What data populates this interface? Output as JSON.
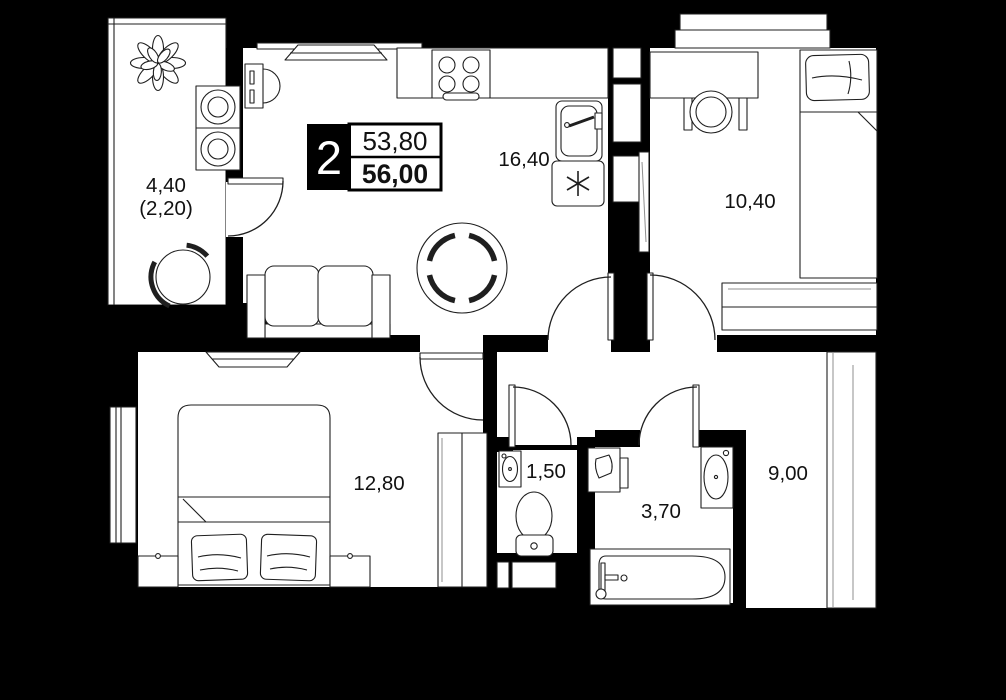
{
  "badge": {
    "rooms_count": "2",
    "living_area": "53,80",
    "total_area": "56,00"
  },
  "room_labels": {
    "balcony": "4,40",
    "balcony_coefficient": "(2,20)",
    "kitchen_living": "16,40",
    "bedroom_right": "10,40",
    "bedroom_left": "12,80",
    "wc": "1,50",
    "bathroom": "3,70",
    "hallway": "9,00"
  },
  "colors": {
    "background": "#000000",
    "floor": "#ffffff",
    "wall": "#000000",
    "line": "#1f1f1f",
    "text": "#111111",
    "muted_line": "#8f8f8f"
  }
}
